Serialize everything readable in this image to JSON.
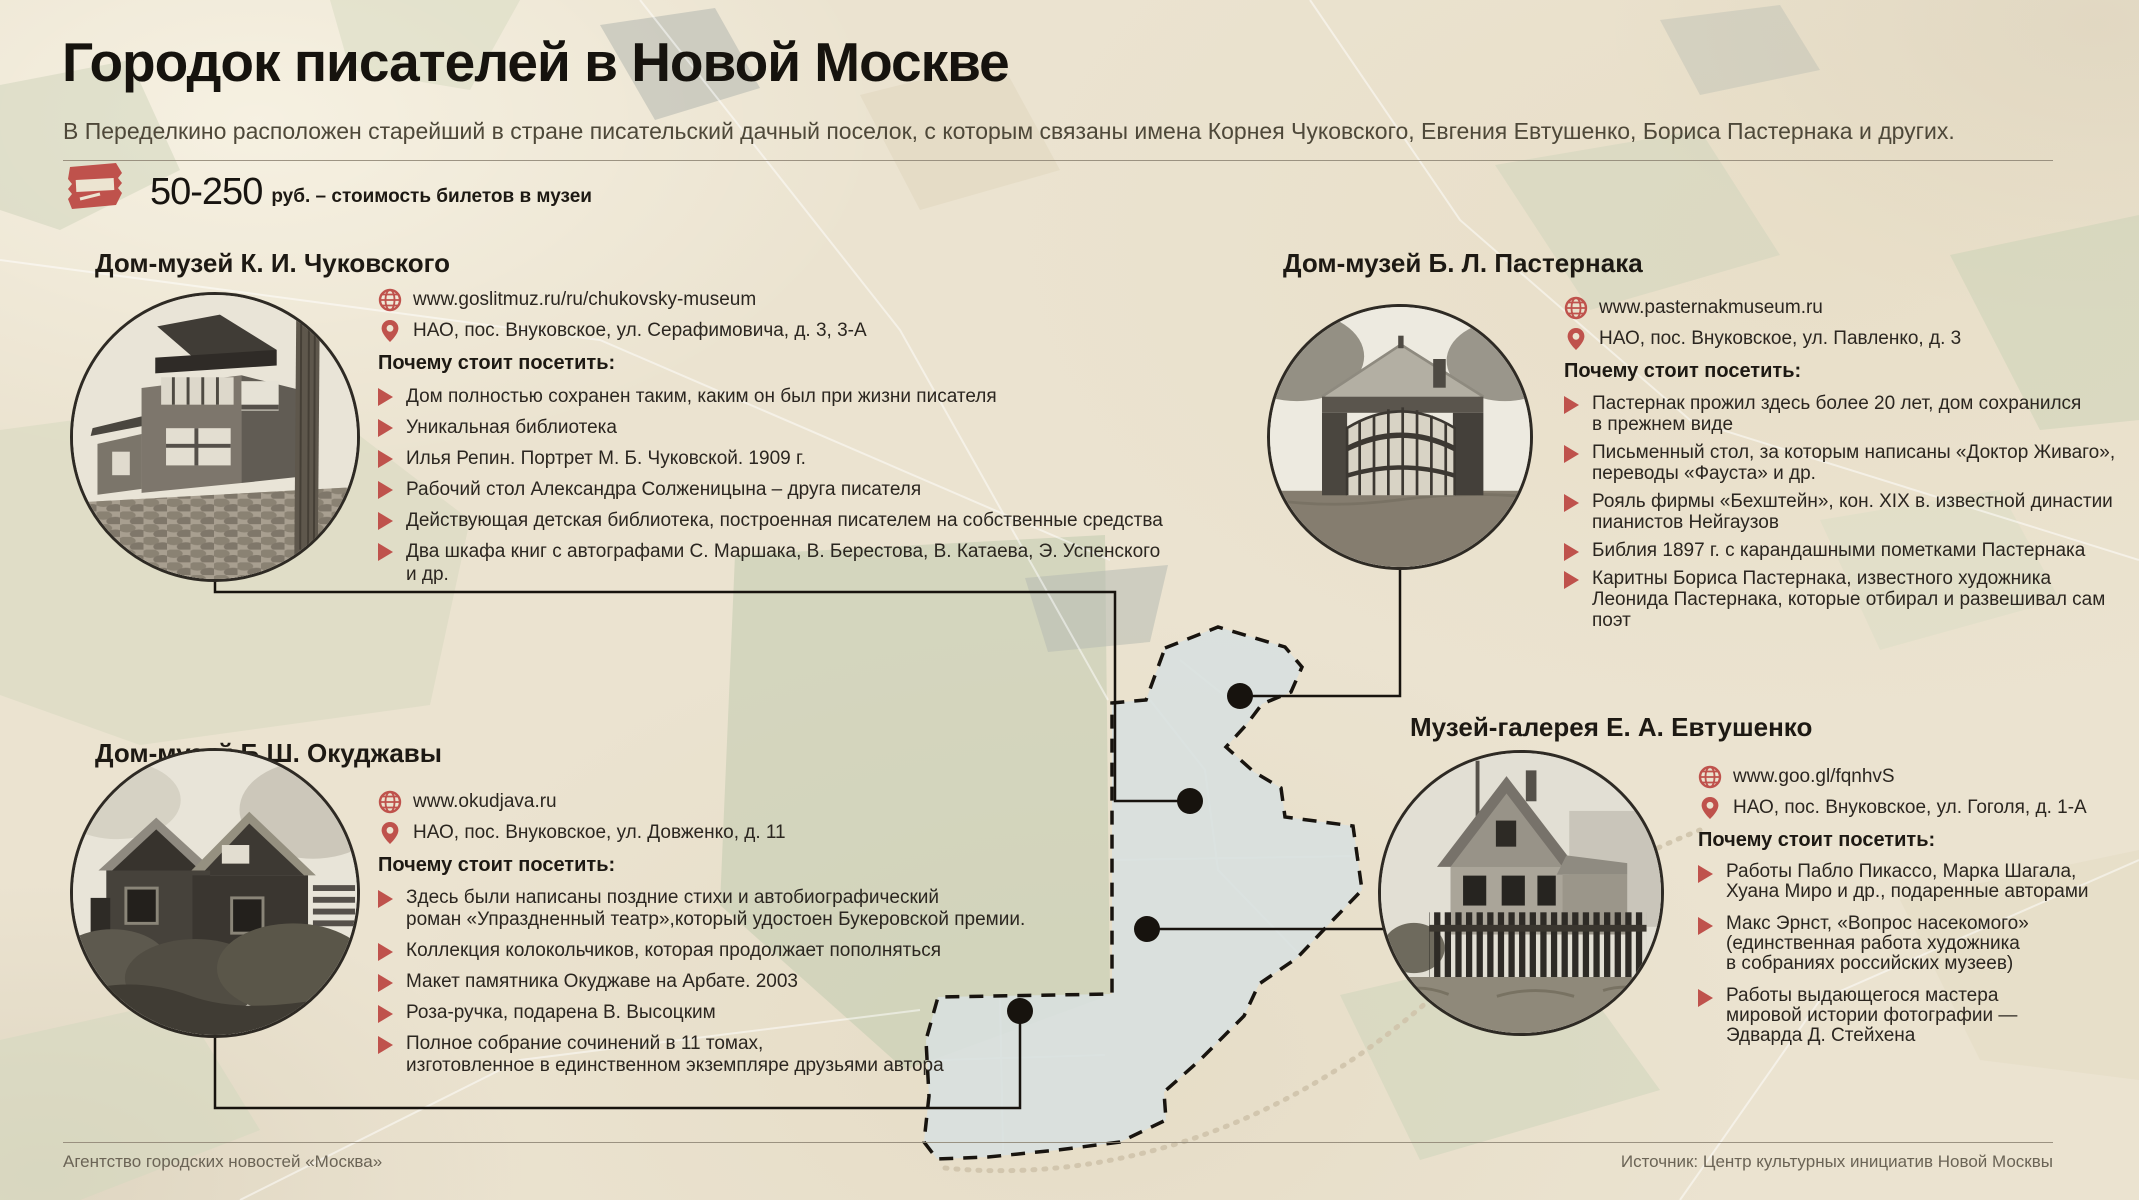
{
  "header": {
    "title": "Городок писателей в Новой Москве",
    "subtitle": "В Переделкино расположен старейший в стране писательский дачный поселок, с которым связаны имена Корнея Чуковского, Евгения Евтушенко, Бориса Пастернака и других.",
    "ticket": {
      "icon": "ticket-icon",
      "price": "50-250",
      "caption": "руб. – стоимость билетов в музеи"
    }
  },
  "labels": {
    "why_visit": "Почему стоит посетить:"
  },
  "museums": [
    {
      "id": "chukovsky",
      "title": "Дом-музей К. И. Чуковского",
      "website": "www.goslitmuz.ru/ru/chukovsky-museum",
      "address": "НАО, пос. Внуковское, ул. Серафимовича, д. 3, 3-А",
      "highlights": [
        "Дом полностью сохранен таким, каким он был при жизни писателя",
        "Уникальная библиотека",
        "Илья Репин. Портрет М. Б. Чуковской. 1909 г.",
        "Рабочий стол Александра Солженицына – друга писателя",
        "Действующая детская библиотека, построенная писателем на собственные средства",
        "Два шкафа книг с автографами С. Маршака, В. Берестова, В. Катаева, Э. Успенского и др."
      ]
    },
    {
      "id": "pasternak",
      "title": "Дом-музей Б. Л. Пастернака",
      "website": "www.pasternakmuseum.ru",
      "address": "НАО, пос. Внуковское, ул. Павленко, д. 3",
      "highlights": [
        "Пастернак прожил здесь более 20 лет, дом сохранился\nв прежнем виде",
        "Письменный стол, за которым написаны «Доктор Живаго»,\nпереводы «Фауста» и др.",
        "Рояль фирмы «Бехштейн», кон. XIX в. известной династии\nпианистов Нейгаузов",
        "Библия 1897 г. с карандашными пометками Пастернака",
        "Каритны Бориса Пастернака, известного художника\nЛеонида Пастернака, которые отбирал и развешивал сам поэт"
      ]
    },
    {
      "id": "okudzhava",
      "title": "Дом-музей Б.Ш. Окуджавы",
      "website": "www.okudjava.ru",
      "address": "НАО, пос. Внуковское, ул. Довженко, д. 11",
      "highlights": [
        "Здесь были написаны поздние стихи и автобиографический\nроман «Упраздненный театр»,который удостоен Букеровской премии.",
        "Коллекция колокольчиков, которая продолжает пополняться",
        "Макет памятника Окуджаве на Арбате. 2003",
        "Роза-ручка, подарена В. Высоцким",
        "Полное собрание сочинений в 11 томах,\nизготовленное в единственном экземпляре друзьями автора"
      ]
    },
    {
      "id": "yevtushenko",
      "title": "Музей-галерея Е. А. Евтушенко",
      "website": "www.goo.gl/fqnhvS",
      "address": "НАО, пос. Внуковское, ул. Гоголя, д. 1-А",
      "highlights": [
        "Работы Пабло Пикассо, Марка Шагала,\nХуана Миро и др., подаренные авторами",
        "Макс Эрнст, «Вопрос насекомого»\n(единственная работа художника\nв собраниях российских музеев)",
        "Работы выдающегося мастера\nмировой истории фотографии —\nЭдварда Д. Стейхена"
      ]
    }
  ],
  "footer": {
    "left": "Агентство городских новостей «Москва»",
    "right": "Источник: Центр культурных инициатив Новой Москвы"
  },
  "colors": {
    "background": "#ebe3d0",
    "accent_red": "#bf524c",
    "map_area_fill": "#d8e0df",
    "text_dark": "#2b2620",
    "muted_text": "#6b6456"
  }
}
